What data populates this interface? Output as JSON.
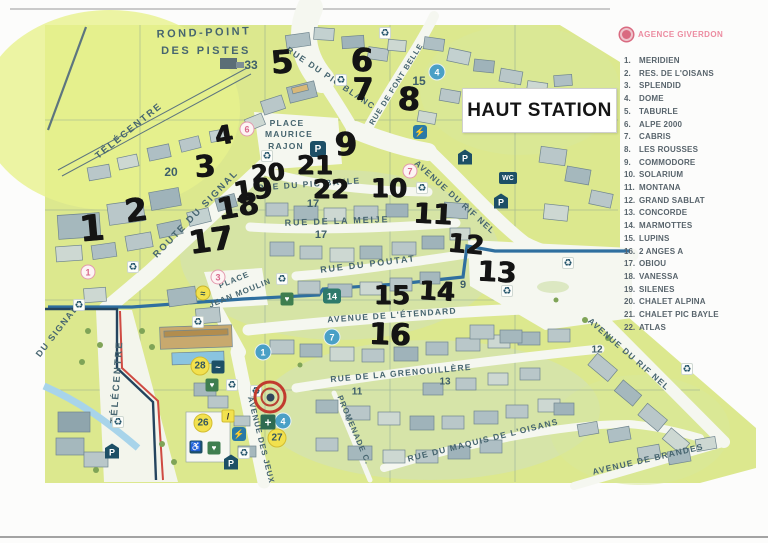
{
  "sign": {
    "title": "HAUT STATION"
  },
  "legend": {
    "agency": "AGENCE GIVERDON",
    "items": [
      {
        "num": "1.",
        "name": "MERIDIEN"
      },
      {
        "num": "2.",
        "name": "RES. DE L'OISANS"
      },
      {
        "num": "3.",
        "name": "SPLENDID"
      },
      {
        "num": "4.",
        "name": "DOME"
      },
      {
        "num": "5.",
        "name": "TABURLE"
      },
      {
        "num": "6.",
        "name": "ALPE 2000"
      },
      {
        "num": "7.",
        "name": "CABRIS"
      },
      {
        "num": "8.",
        "name": "LES ROUSSES"
      },
      {
        "num": "9.",
        "name": "COMMODORE"
      },
      {
        "num": "10.",
        "name": "SOLARIUM"
      },
      {
        "num": "11.",
        "name": "MONTANA"
      },
      {
        "num": "12.",
        "name": "GRAND SABLAT"
      },
      {
        "num": "13.",
        "name": "CONCORDE"
      },
      {
        "num": "14.",
        "name": "MARMOTTES"
      },
      {
        "num": "15.",
        "name": "LUPINS"
      },
      {
        "num": "16.",
        "name": "2 ANGES A"
      },
      {
        "num": "17.",
        "name": "OBIOU"
      },
      {
        "num": "18.",
        "name": "VANESSA"
      },
      {
        "num": "19.",
        "name": "SILENES"
      },
      {
        "num": "20.",
        "name": "CHALET ALPINA"
      },
      {
        "num": "21.",
        "name": "CHALET PIC BAYLE"
      },
      {
        "num": "22.",
        "name": "ATLAS"
      }
    ]
  },
  "map": {
    "streets": [
      {
        "name": "ROND-POINT"
      },
      {
        "name": "DES PISTES"
      },
      {
        "name": "RUE DU PIC BLANC"
      },
      {
        "name": "RUE DE FONT BELLE"
      },
      {
        "name": "TÉLÉCENTRE"
      },
      {
        "name": "TÉLÉCENTRE"
      },
      {
        "name": "ROUTE DU SIGNAL"
      },
      {
        "name": "DU SIGNAL"
      },
      {
        "name": "RUE DU PIC BAYLE"
      },
      {
        "name": "RUE DE LA MEIJE"
      },
      {
        "name": "RUE DU POUTAT"
      },
      {
        "name": "AVENUE DU RIF NEL"
      },
      {
        "name": "AVENUE DE L'ÉTENDARD"
      },
      {
        "name": "RUE DE LA GRENOUILLÈRE"
      },
      {
        "name": "PROMENADE C."
      },
      {
        "name": "RUE DU MAQUIS DE L'OISANS"
      },
      {
        "name": "AVENUE DES JEUX"
      },
      {
        "name": "AVENUE DU RIF NEL"
      },
      {
        "name": "AVENUE DE BRANDES"
      },
      {
        "name": "PLACE"
      },
      {
        "name": "MAURICE"
      },
      {
        "name": "RAJON"
      },
      {
        "name": "PLACE"
      },
      {
        "name": "JEAN MOULIN"
      }
    ],
    "handwritten": [
      {
        "v": "1"
      },
      {
        "v": "2"
      },
      {
        "v": "3"
      },
      {
        "v": "4"
      },
      {
        "v": "5"
      },
      {
        "v": "6"
      },
      {
        "v": "7"
      },
      {
        "v": "8"
      },
      {
        "v": "9"
      },
      {
        "v": "10"
      },
      {
        "v": "11"
      },
      {
        "v": "12"
      },
      {
        "v": "13"
      },
      {
        "v": "14"
      },
      {
        "v": "15"
      },
      {
        "v": "16"
      },
      {
        "v": "17"
      },
      {
        "v": "18"
      },
      {
        "v": "19"
      },
      {
        "v": "20"
      },
      {
        "v": "21"
      },
      {
        "v": "22"
      }
    ],
    "printed": [
      {
        "v": "33"
      },
      {
        "v": "20"
      },
      {
        "v": "15"
      },
      {
        "v": "17"
      },
      {
        "v": "17"
      },
      {
        "v": "9"
      },
      {
        "v": "11"
      },
      {
        "v": "13"
      },
      {
        "v": "12"
      }
    ],
    "blue_markers": [
      {
        "v": "4"
      },
      {
        "v": "1"
      },
      {
        "v": "7"
      },
      {
        "v": "4"
      }
    ],
    "pink_markers": [
      {
        "v": "6"
      },
      {
        "v": "7"
      },
      {
        "v": "3"
      },
      {
        "v": "1"
      }
    ],
    "yellow_markers": [
      {
        "v": "28"
      },
      {
        "v": "26"
      },
      {
        "v": "27"
      }
    ],
    "green_marker": {
      "v": "14"
    }
  },
  "icons": {
    "parking": "P",
    "wc": "WC",
    "recycle": "♻",
    "wheelchair": "♿",
    "charging": "⚡",
    "spa": "♥",
    "first_aid": "+",
    "ski_school": "≈",
    "slide": "~",
    "skier": "/"
  },
  "colors": {
    "map_green": "#dce88e",
    "street_white": "#f5f7f0",
    "stream_blue": "#2f6f9f",
    "piste_red": "#cf4a42",
    "marker_blue": "#4aa0c6",
    "marker_pink": "#e49aae",
    "marker_yellow": "#f2e14e",
    "navy_icon": "#1d4f66",
    "agency_pink": "#ec8ba0"
  }
}
